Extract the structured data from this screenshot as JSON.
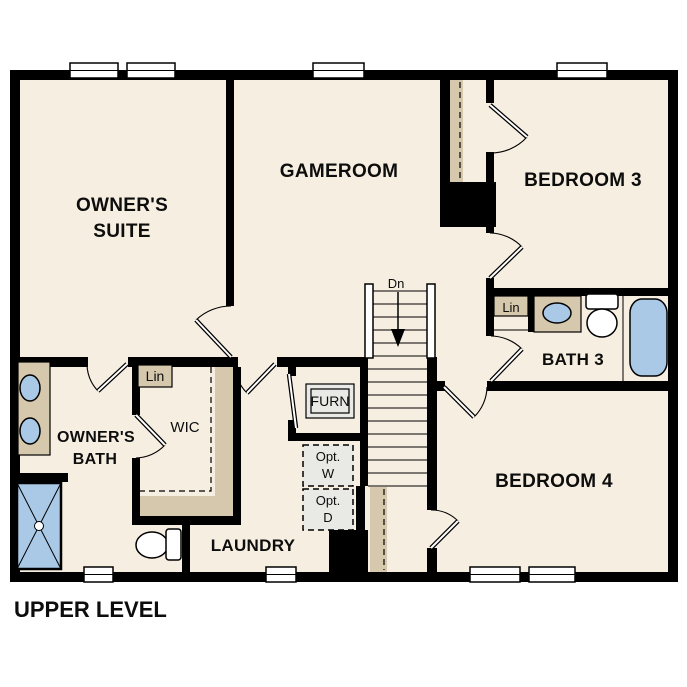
{
  "plan_title": "UPPER LEVEL",
  "rooms": {
    "owners_suite_line1": "OWNER'S",
    "owners_suite_line2": "SUITE",
    "gameroom": "GAMEROOM",
    "bedroom3": "BEDROOM 3",
    "bath3": "BATH 3",
    "bedroom4": "BEDROOM 4",
    "owners_bath_line1": "OWNER'S",
    "owners_bath_line2": "BATH",
    "wic": "WIC",
    "laundry": "LAUNDRY"
  },
  "labels": {
    "stairs_down": "Dn",
    "furnace": "FURN",
    "linen_wic": "Lin",
    "linen_bath3": "Lin",
    "opt_washer_line1": "Opt.",
    "opt_washer_line2": "W",
    "opt_dryer_line1": "Opt.",
    "opt_dryer_line2": "D"
  },
  "fixtures": [
    "double-vanity-with-two-sinks",
    "walk-in-shower",
    "toilet-owners-bath",
    "toilet-bath3",
    "single-vanity-sink-bath3",
    "bathtub-bath3",
    "stairs-down",
    "linen-closet-wic",
    "linen-closet-bath3",
    "optional-washer",
    "optional-dryer",
    "furnace",
    "closet-shelving"
  ],
  "colors": {
    "wall": "#000000",
    "floor": "#f6eee1",
    "counter": "#d6c8ad",
    "fixture": "#a9c9e6",
    "appliance": "#e9e9e6",
    "paper": "#ffffff",
    "text": "#0d0d0d"
  }
}
